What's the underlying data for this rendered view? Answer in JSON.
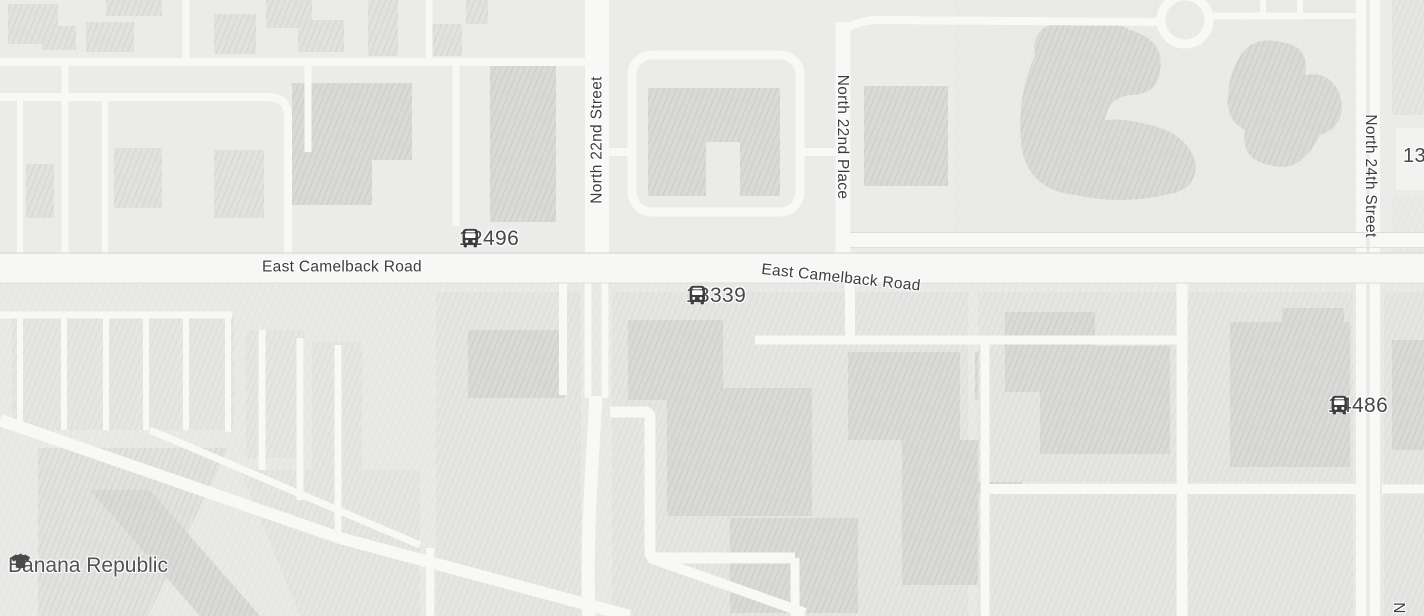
{
  "labels": {
    "camelback_west": "East Camelback Road",
    "camelback_east": "East Camelback Road",
    "street_22nd_st": "North 22nd Street",
    "street_22nd_pl": "North 22nd Place",
    "street_24th_st": "North 24th Street",
    "partial_right": "13",
    "partial_bottom_n": "N"
  },
  "bus_stops": [
    {
      "stop_id": "12496"
    },
    {
      "stop_id": "13339"
    },
    {
      "stop_id": "14486"
    }
  ],
  "poi": {
    "banana_republic": {
      "name": "Banana Republic",
      "icon": "clothing-store"
    }
  },
  "colors": {
    "background": "#ebebe9",
    "road": "#f8f8f7",
    "building_fill": "#e1e1df",
    "building_hatch": "#cccccb",
    "label_text": "#3c3c3c",
    "marker_glyph": "#3d3d3d"
  }
}
